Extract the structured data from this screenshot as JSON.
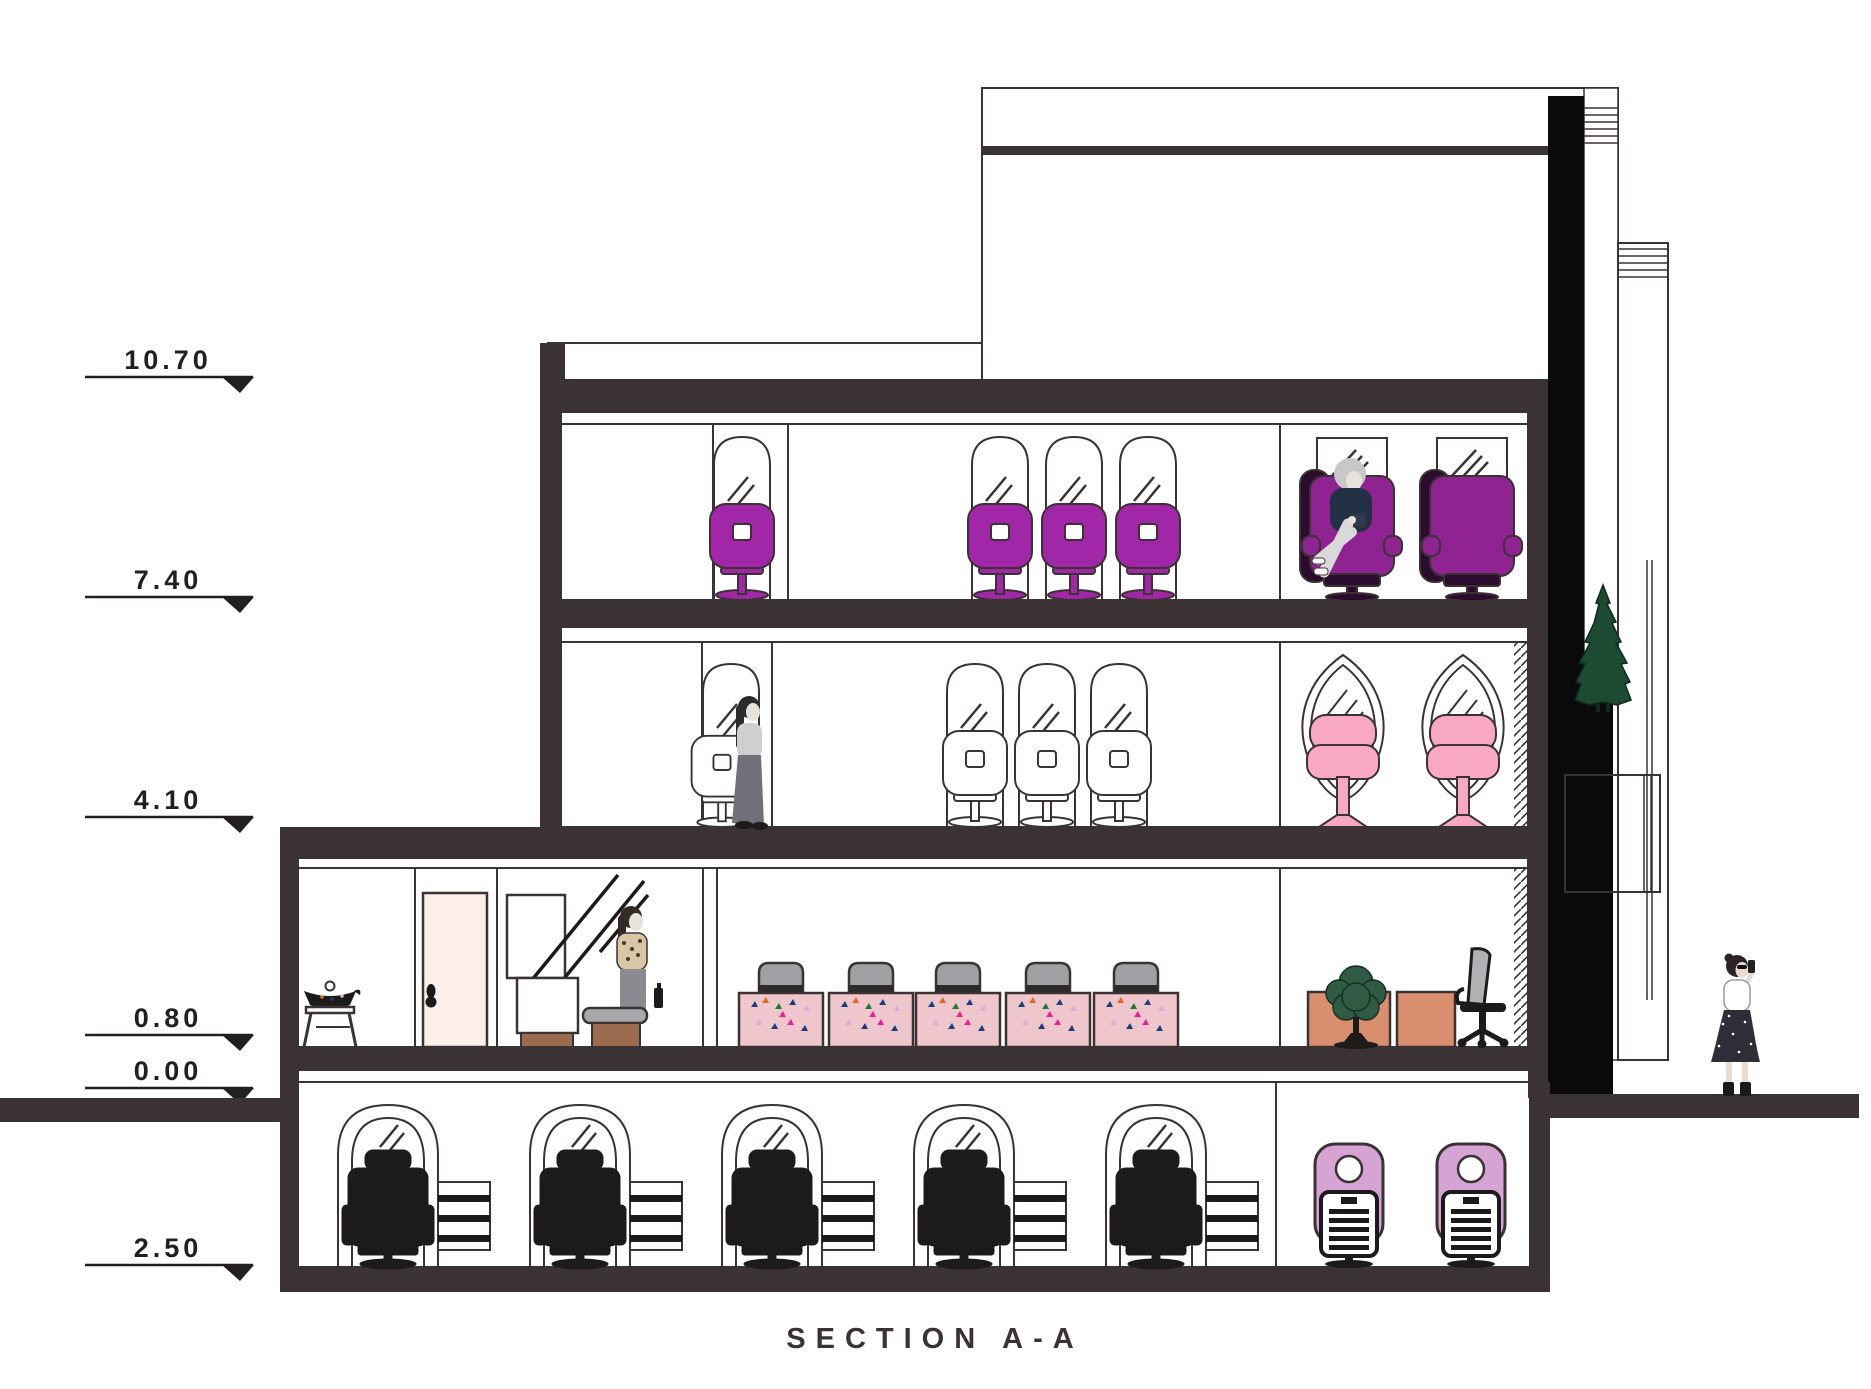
{
  "title": "SECTION A-A",
  "elevations": [
    "10.70",
    "7.40",
    "4.10",
    "0.80",
    "0.00",
    "2.50"
  ],
  "colors": {
    "structure": "#3b3234",
    "line_dark": "#231f20",
    "floor3_fill": "#eed9ef",
    "floor2_fill": "#fbdae8",
    "ground_fill": "#fdefe9",
    "basement_fill": "#e9e9e9",
    "chair_purple": "#a126a8",
    "recliner_magenta": "#8f2391",
    "recliner_dark": "#2b0b2e",
    "chair_pink": "#f9a8c4",
    "wash_lilac": "#d5a3d4",
    "dryer_pink": "#eec6cc",
    "dryer_hood": "#9fa0a4",
    "desk_salmon": "#d98e6e",
    "wood_brown": "#9a6b4f",
    "tree_green": "#1d4a33",
    "topiary_green": "#2f5b45",
    "chair_black": "#1c1a1b",
    "shaft_black": "#0a0a0a"
  }
}
